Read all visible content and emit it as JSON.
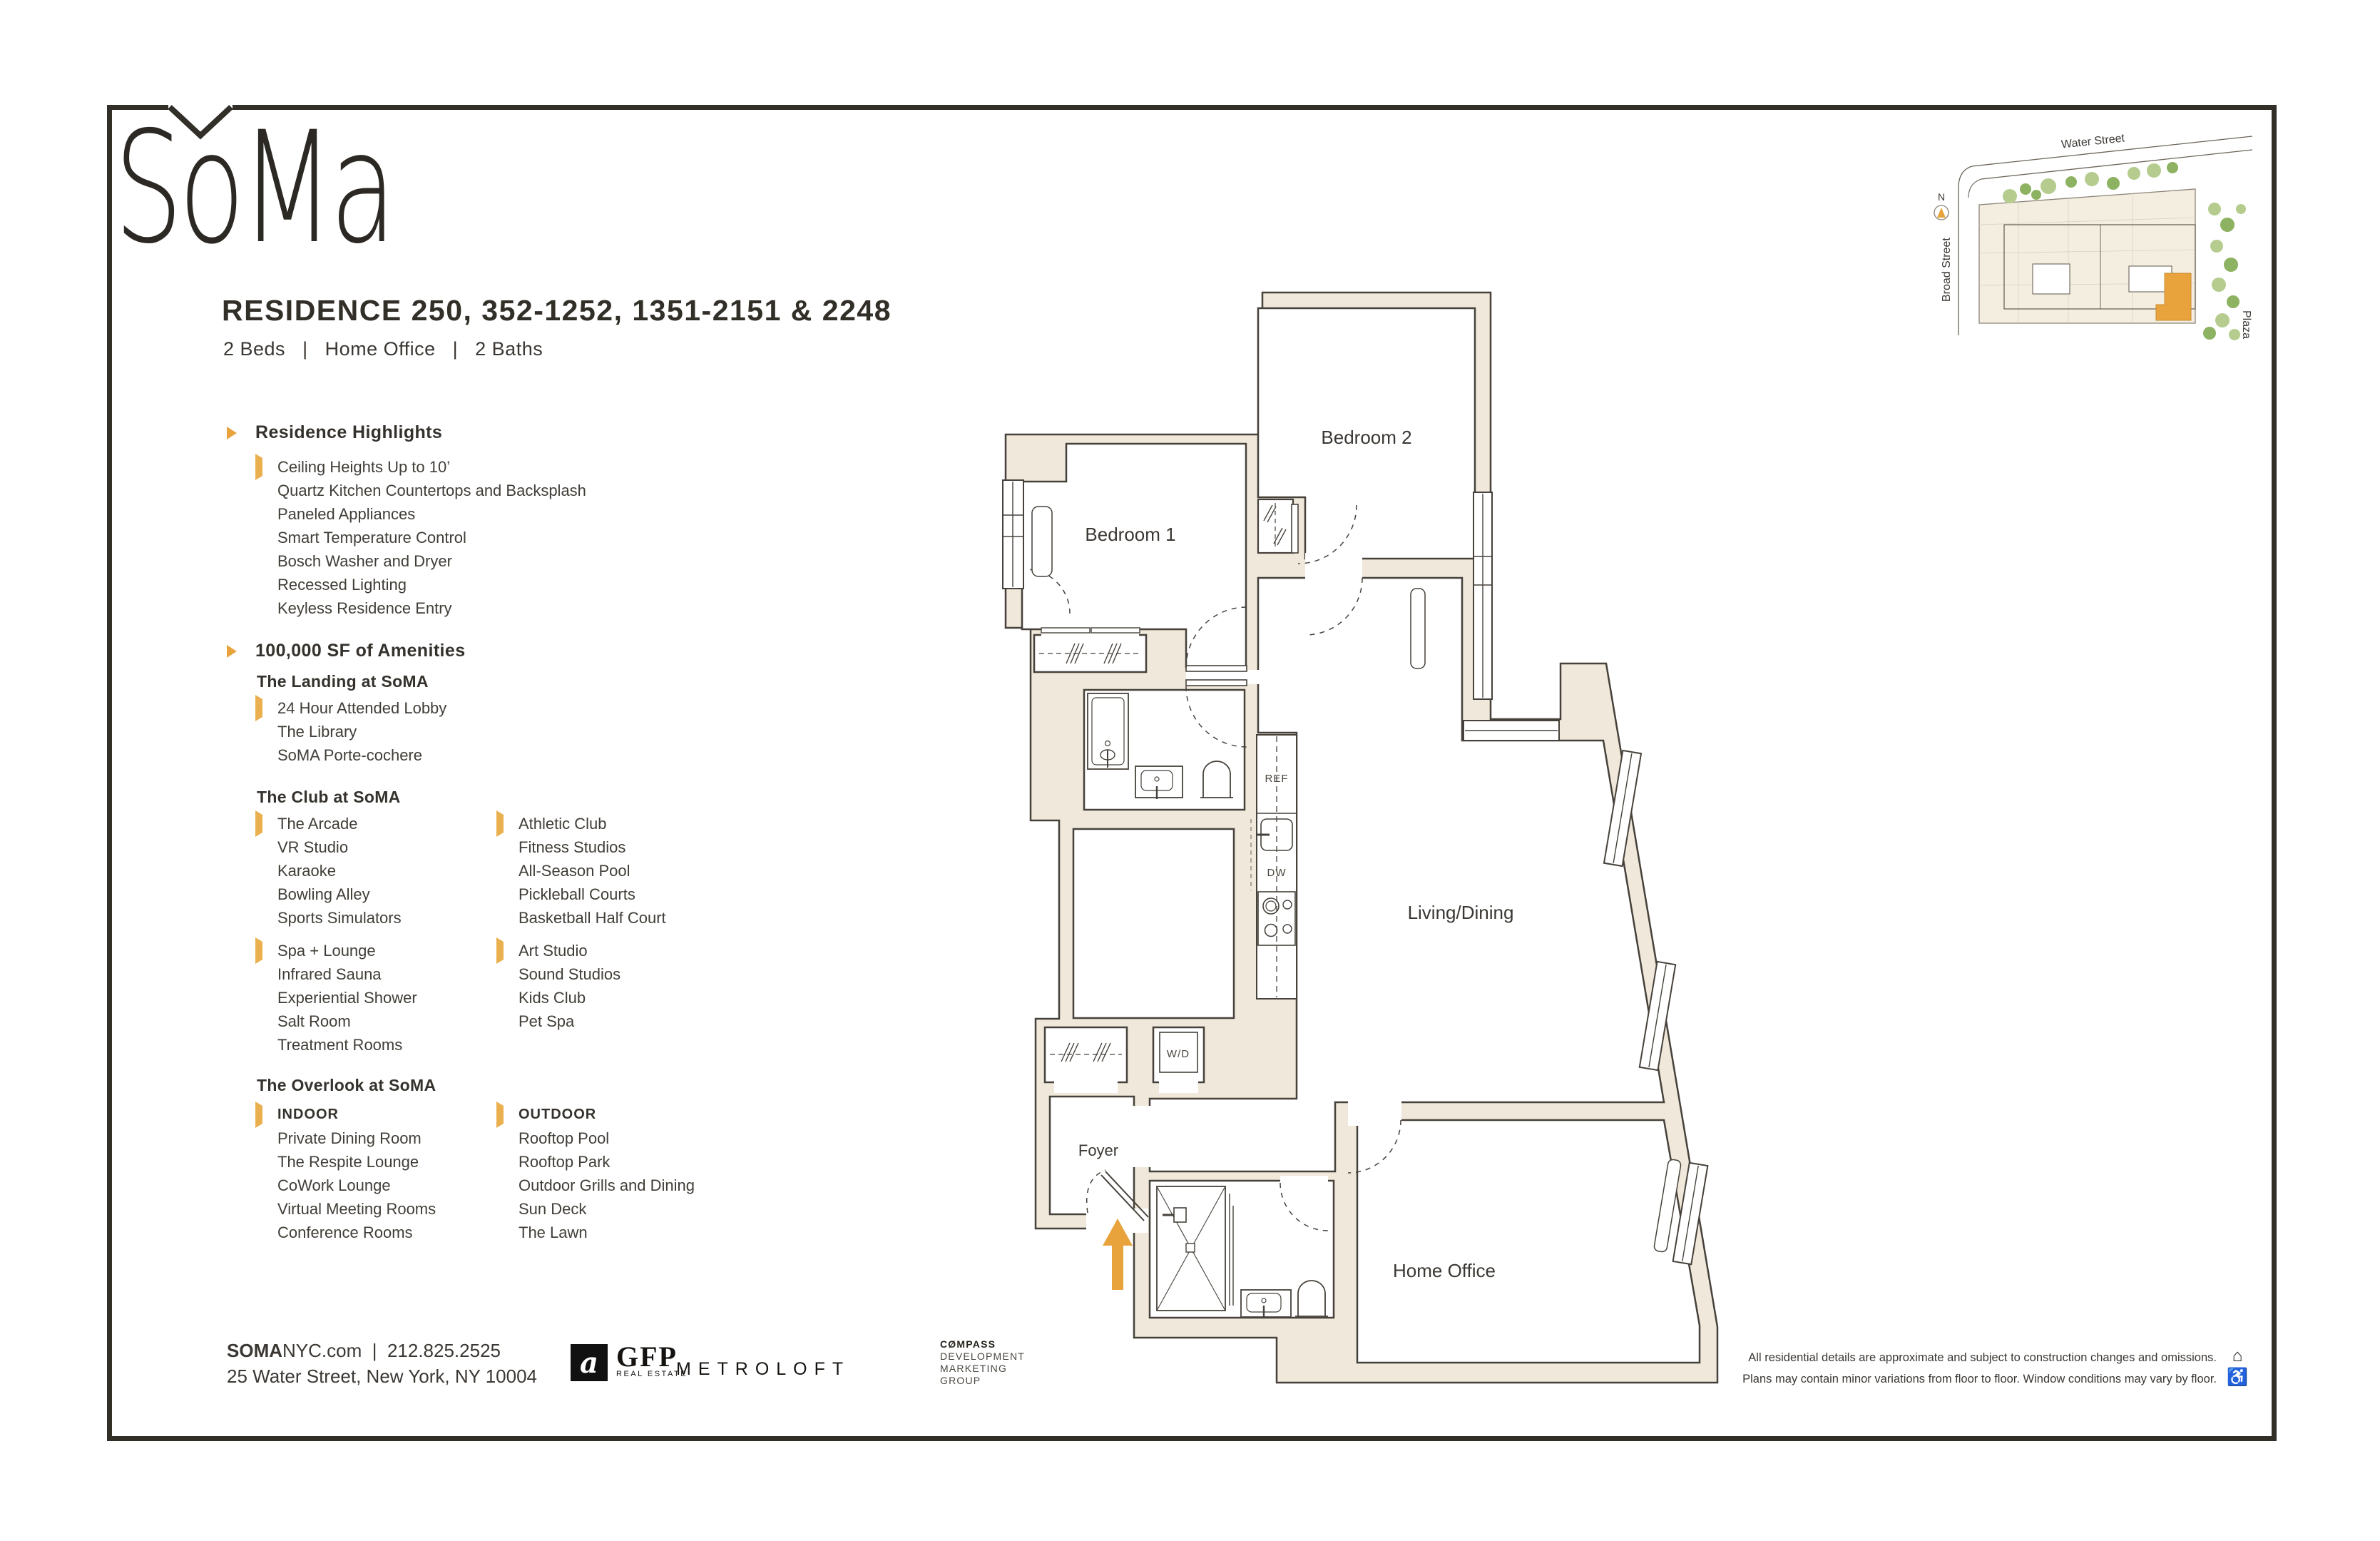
{
  "brand": {
    "logo_text": "SoMa"
  },
  "header": {
    "title": "RESIDENCE 250, 352-1252, 1351-2151 & 2248",
    "subtitle": "2 Beds   |   Home Office   |   2 Baths"
  },
  "highlights": {
    "heading": "Residence Highlights",
    "items": [
      "Ceiling Heights Up to 10’",
      "Quartz Kitchen Countertops and Backsplash",
      "Paneled Appliances",
      "Smart Temperature Control",
      "Bosch Washer and Dryer",
      "Recessed Lighting",
      "Keyless Residence Entry"
    ]
  },
  "amenities": {
    "heading": "100,000 SF of Amenities",
    "landing": {
      "title": "The Landing at SoMA",
      "items": [
        "24 Hour Attended Lobby",
        "The Library",
        "SoMA Porte-cochere"
      ]
    },
    "club": {
      "title": "The Club at SoMA",
      "col1a": [
        "The Arcade",
        "VR Studio",
        "Karaoke",
        "Bowling Alley",
        "Sports Simulators"
      ],
      "col2a": [
        "Athletic Club",
        "Fitness Studios",
        "All-Season Pool",
        "Pickleball Courts",
        "Basketball Half Court"
      ],
      "col1b": [
        "Spa + Lounge",
        "Infrared Sauna",
        "Experiential Shower",
        "Salt Room",
        "Treatment Rooms"
      ],
      "col2b": [
        "Art Studio",
        "Sound Studios",
        "Kids Club",
        "Pet Spa"
      ]
    },
    "overlook": {
      "title": "The Overlook at SoMA",
      "indoor_label": "INDOOR",
      "indoor": [
        "Private Dining Room",
        "The Respite Lounge",
        "CoWork Lounge",
        "Virtual Meeting Rooms",
        "Conference Rooms"
      ],
      "outdoor_label": "OUTDOOR",
      "outdoor": [
        "Rooftop Pool",
        "Rooftop Park",
        "Outdoor Grills and Dining",
        "Sun Deck",
        "The Lawn"
      ]
    }
  },
  "floorplan": {
    "bedroom1": "Bedroom 1",
    "bedroom2": "Bedroom 2",
    "living": "Living/Dining",
    "home_office": "Home Office",
    "foyer": "Foyer",
    "ref": "REF",
    "dw": "DW",
    "wd": "W/D"
  },
  "sitemap": {
    "water": "Water Street",
    "broad": "Broad Street",
    "plaza": "Plaza",
    "north": "N"
  },
  "footer": {
    "site_bold": "SOMA",
    "site_rest": "NYC.com",
    "sep": "|",
    "phone": "212.825.2525",
    "address": "25 Water Street, New York, NY 10004",
    "gfp_icon": "a",
    "gfp": "GFP",
    "gfp_sub": "REAL ESTATE",
    "metroloft": "METROLOFT",
    "compass1": "CØMPASS",
    "compass2": "DEVELOPMENT",
    "compass3": "MARKETING",
    "compass4": "GROUP"
  },
  "disclaimer": {
    "line1": "All residential details are approximate and subject to construction changes and omissions.",
    "line2": "Plans may contain minor variations from floor to floor. Window conditions may vary by floor.",
    "house_icon": "⌂",
    "access_icon": "♿"
  },
  "colors": {
    "accent": "#e8a33d",
    "wall": "#efe8db",
    "line": "#46413a",
    "frame": "#322e28"
  }
}
